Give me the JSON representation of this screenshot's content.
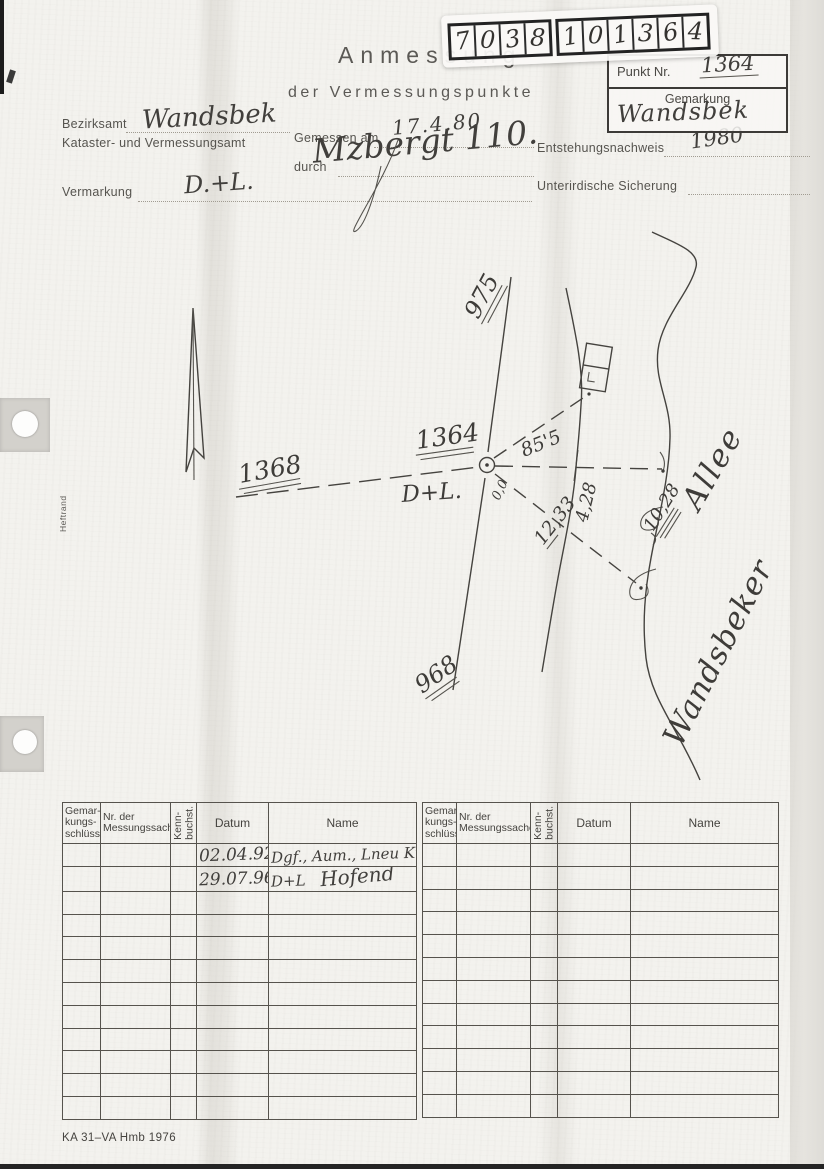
{
  "header": {
    "title": "Anmessung",
    "subtitle": "der Vermessungspunkte",
    "sticker": {
      "digits": [
        "7",
        "0",
        "3",
        "8",
        "1",
        "0",
        "1",
        "3",
        "6",
        "4"
      ]
    },
    "punkt": {
      "label": "Punkt Nr.",
      "value": "1364",
      "gemarkung_label": "Gemarkung",
      "gemarkung_value": "Wandsbek"
    },
    "fields": {
      "bezirksamt_label": "Bezirksamt",
      "bezirksamt_value": "Wandsbek",
      "kataster_label": "Kataster- und Vermessungsamt",
      "gemessen_label": "Gemessen am",
      "gemessen_value": "17.4.80",
      "durch_label": "durch",
      "durch_value": "Mzbergt 110.",
      "entstehung_label": "Entstehungsnachweis",
      "entstehung_value": "1980",
      "vermarkung_label": "Vermarkung",
      "vermarkung_value": "D.+L.",
      "sicherung_label": "Unterirdische Sicherung",
      "sicherung_value": ""
    }
  },
  "sketch": {
    "labels": {
      "p1368": "1368",
      "p1364": "1364",
      "p975": "975",
      "p968": "968",
      "dl": "D+L.",
      "m85": "85'5",
      "m428": "4,28",
      "m1028": "10,28",
      "m1233": "12,33",
      "m00": "0,0",
      "street1": "Wandsbeker",
      "street2": "Allee"
    }
  },
  "table": {
    "headers": {
      "gemarkung": "Gemar-\nkungs-\nschlüssel",
      "nr": "Nr. der\nMessungssache",
      "kenn": "Kenn-\nbuchst.",
      "datum": "Datum",
      "name": "Name"
    },
    "entries": [
      {
        "datum": "02.04.92",
        "name": "Dgf., Aum., Lneu Kiö"
      },
      {
        "datum": "29.07.96.",
        "name_left": "D+L",
        "name_sig": "Hofend"
      }
    ]
  },
  "margin": {
    "heftrand": "Heftrand"
  },
  "footer": {
    "form_code": "KA 31–VA Hmb 1976"
  }
}
